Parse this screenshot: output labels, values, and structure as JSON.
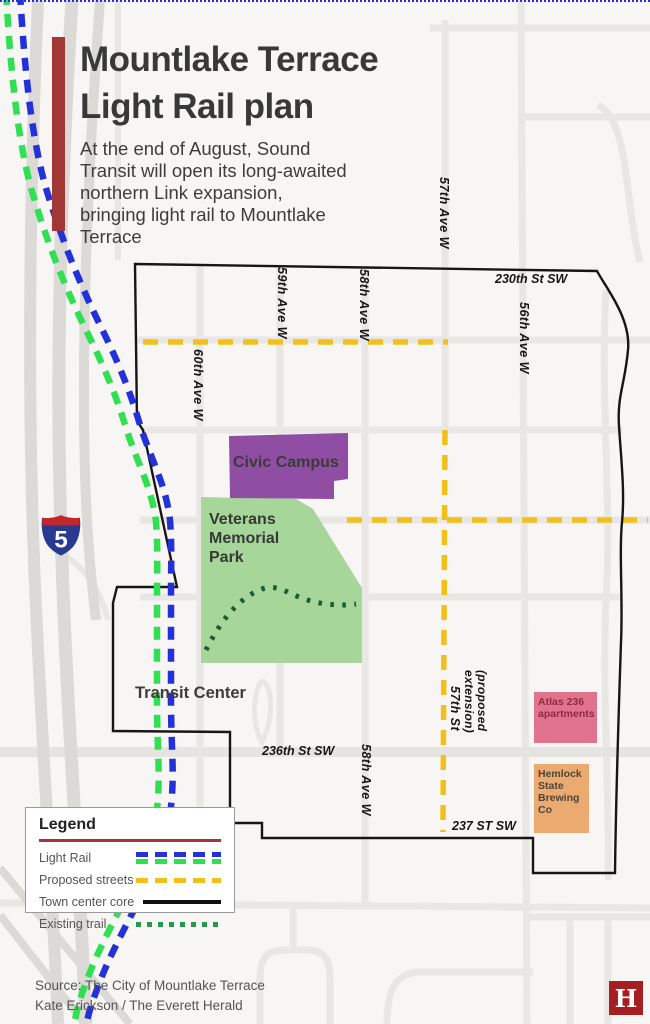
{
  "header": {
    "title_line1": "Mountlake Terrace",
    "title_line2": "Light Rail plan",
    "subtitle_lines": [
      "At the end of August, Sound",
      "Transit will open its long-awaited",
      "northern Link expansion,",
      "bringing light rail to Mountlake",
      "Terrace"
    ]
  },
  "map": {
    "labels": {
      "street_230th": "230th St SW",
      "ave_59th": "59th Ave W",
      "ave_58th_top": "58th Ave W",
      "ave_57th": "57th Ave W",
      "ave_56th": "56th Ave W",
      "ave_60th": "60th Ave W",
      "ave_58th_bottom": "58th Ave W",
      "street_236th": "236th St SW",
      "street_237": "237 ST SW",
      "proposed_extension": "(proposed extension)",
      "proposed_57th": "57th St",
      "transit_center": "Transit Center",
      "civic_campus": "Civic Campus",
      "veterans_park": "Veterans Memorial Park",
      "atlas_apartments": "Atlas 236 apartments",
      "hemlock_brewing": "Hemlock State Brewing Co",
      "interstate_number": "5"
    }
  },
  "legend": {
    "title": "Legend",
    "items": [
      {
        "label": "Light Rail"
      },
      {
        "label": "Proposed streets"
      },
      {
        "label": "Town center core"
      },
      {
        "label": "Existing trail"
      }
    ]
  },
  "footer": {
    "source_line1": "Source: The City of Mountlake Terrace",
    "source_line2": "Kate Erickson / The Everett Herald",
    "logo_letter": "H"
  },
  "colors": {
    "accent_red": "#a23835",
    "light_rail_blue": "#2531d8",
    "light_rail_green": "#30df52",
    "proposed_yellow": "#f3c01b",
    "town_core_black": "#161616",
    "existing_trail_green": "#239b4b",
    "park_trail_green": "#1c5a30",
    "park_green": "#a6d699",
    "civic_purple": "#8f4da4",
    "atlas_pink": "#e2738e",
    "hemlock_orange": "#eaaa70",
    "logo_red": "#a51e22"
  }
}
